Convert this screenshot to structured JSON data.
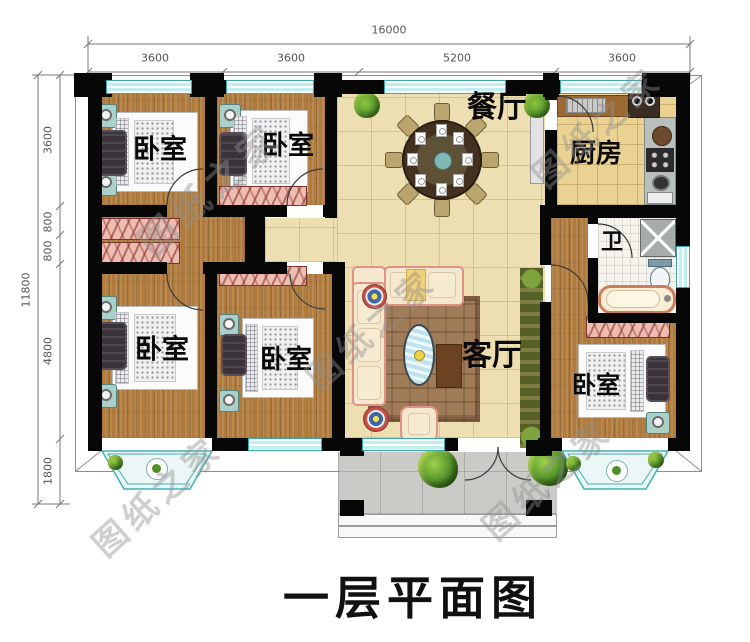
{
  "title": "一层平面图",
  "watermark": {
    "text": "图纸之家"
  },
  "dimensions": {
    "top": {
      "total": "16000",
      "segments": [
        "3600",
        "3600",
        "5200",
        "3600"
      ]
    },
    "left": {
      "total": "11800",
      "segments": [
        "3600",
        "800",
        "800",
        "4800",
        "1800"
      ]
    }
  },
  "rooms": [
    {
      "id": "bedroom-top-left",
      "label": "卧室"
    },
    {
      "id": "bedroom-top-mid",
      "label": "卧室"
    },
    {
      "id": "dining-room",
      "label": "餐厅"
    },
    {
      "id": "kitchen",
      "label": "厨房"
    },
    {
      "id": "bathroom",
      "label": "卫"
    },
    {
      "id": "living-room",
      "label": "客厅"
    },
    {
      "id": "bedroom-bottom-left",
      "label": "卧室"
    },
    {
      "id": "bedroom-bottom-mid",
      "label": "卧室"
    },
    {
      "id": "bedroom-right",
      "label": "卧室"
    }
  ],
  "colors": {
    "wall": "#070707",
    "window_glass": "#c2eef0",
    "window_frame": "#3aa7ab",
    "wood_floor": "#b07c3e",
    "tile_floor": "#eedfb2",
    "kitchen_floor": "#ead392",
    "bath_floor": "#f5f3ec",
    "porch_floor": "#cacac6",
    "wardrobe": "#edbcb2",
    "dim_text": "#555555",
    "watermark_gray": "#8f8f8f"
  }
}
